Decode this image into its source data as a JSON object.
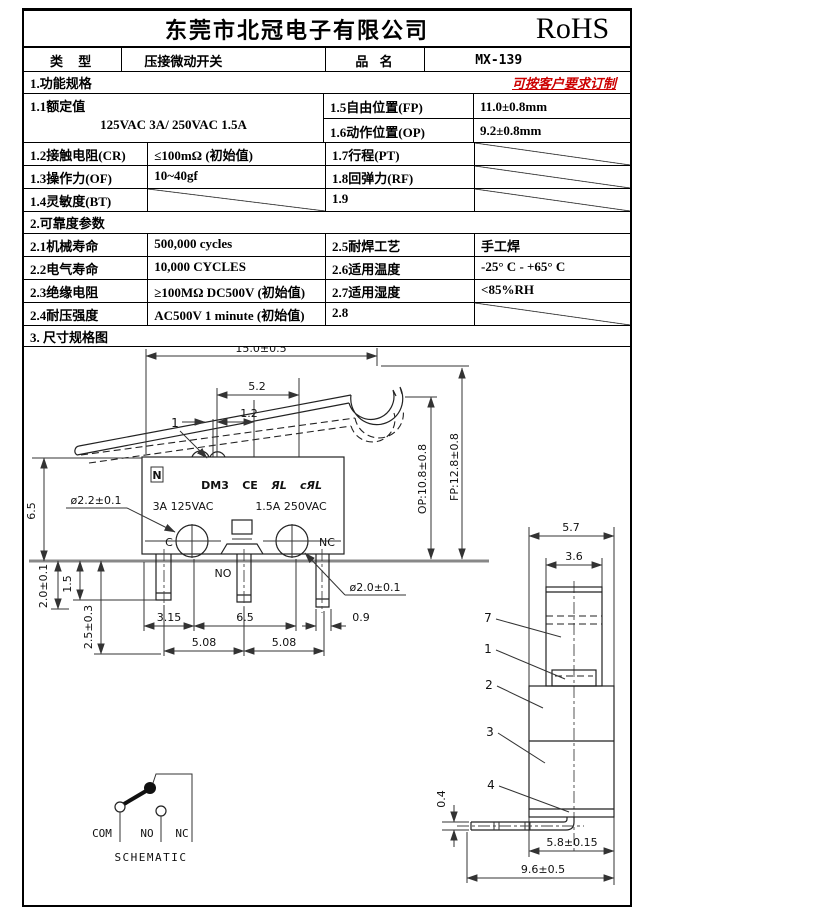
{
  "colors": {
    "note_red": "#cc0000",
    "line_black": "#111111"
  },
  "header": {
    "company": "东莞市北冠电子有限公司",
    "cert": "RoHS",
    "type_label": "类 型",
    "type_value": "压接微动开关",
    "product_label": "品 名",
    "product_value": "MX-139"
  },
  "section1": {
    "title": "1.功能规格",
    "note": "可按客户要求订制",
    "r11_label": "1.1额定值",
    "r11_value": "125VAC 3A/ 250VAC 1.5A",
    "r15_label": "1.5自由位置(FP)",
    "r15_value": "11.0±0.8mm",
    "r16_label": "1.6动作位置(OP)",
    "r16_value": "9.2±0.8mm",
    "r12_label": "1.2接触电阻(CR)",
    "r12_value": "≤100mΩ (初始值)",
    "r17_label": "1.7行程(PT)",
    "r13_label": "1.3操作力(OF)",
    "r13_value": "10~40gf",
    "r18_label": "1.8回弹力(RF)",
    "r14_label": "1.4灵敏度(BT)",
    "r19_label": "1.9"
  },
  "section2": {
    "title": "2.可靠度参数",
    "r21_label": "2.1机械寿命",
    "r21_value": "500,000 cycles",
    "r25_label": "2.5耐焊工艺",
    "r25_value": "手工焊",
    "r22_label": "2.2电气寿命",
    "r22_value": "10,000  CYCLES",
    "r26_label": "2.6适用温度",
    "r26_value": "-25° C - +65° C",
    "r23_label": "2.3绝缘电阻",
    "r23_value": "≥100MΩ DC500V (初始值)",
    "r27_label": "2.7适用湿度",
    "r27_value": "<85%RH",
    "r24_label": "2.4耐压强度",
    "r24_value": "AC500V 1 minute (初始值)",
    "r28_label": "2.8"
  },
  "section3": {
    "title": "3.  尺寸规格图"
  },
  "drawing": {
    "main": {
      "dim_length": "15.0±0.5",
      "dim_52": "5.2",
      "dim_12": "1.2",
      "callout_1": "1",
      "dim_op": "OP:10.8±0.8",
      "dim_fp": "FP:12.8±0.8",
      "dim_height": "6.5",
      "dim_hole_c": "ø2.2±0.1",
      "dim_hole_nc": "ø2.0±0.1",
      "logo_glyph": "N",
      "model": "DM3",
      "ce": "CE",
      "ul": "ЯL",
      "cul": "cЯL",
      "rating_left": "3A 125VAC",
      "rating_right": "1.5A 250VAC",
      "term_c": "C",
      "term_nc": "NC",
      "term_no": "NO",
      "dim_20": "2.0±0.1",
      "dim_15": "1.5",
      "dim_25": "2.5±0.3",
      "dim_315": "3.15",
      "dim_65": "6.5",
      "dim_09": "0.9",
      "dim_508a": "5.08",
      "dim_508b": "5.08"
    },
    "side": {
      "dim_57": "5.7",
      "dim_36": "3.6",
      "c7": "7",
      "c1": "1",
      "c2": "2",
      "c3": "3",
      "c4": "4",
      "dim_04": "0.4",
      "dim_58": "5.8±0.15",
      "dim_96": "9.6±0.5"
    },
    "schematic": {
      "com": "COM",
      "no": "NO",
      "nc": "NC",
      "title": "SCHEMATIC"
    }
  }
}
